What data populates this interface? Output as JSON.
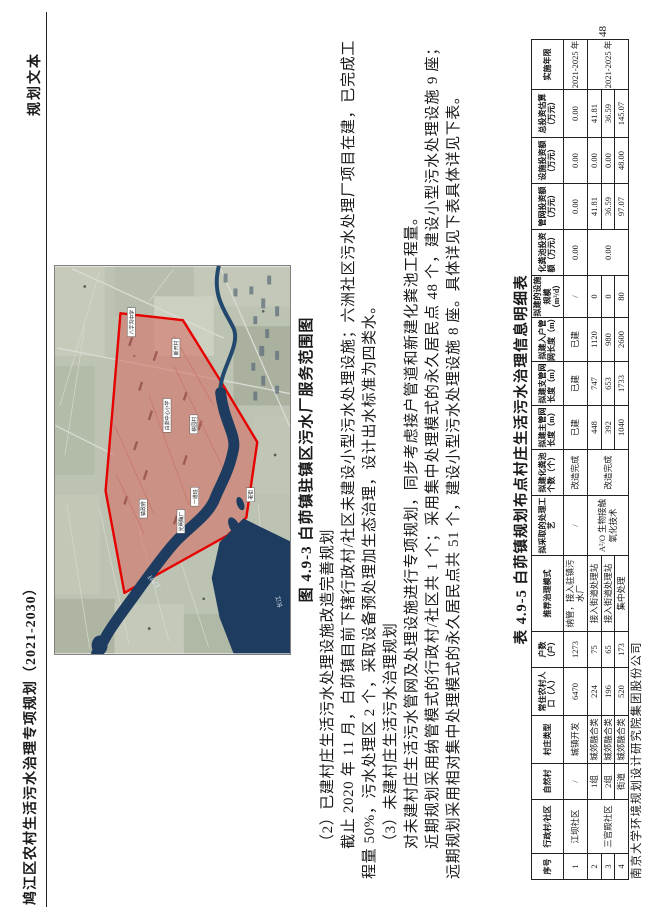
{
  "header": {
    "title": "鸠江区农村生活污水治理专项规划（2021-2030）",
    "doc_type": "规划文本"
  },
  "footer": {
    "company": "南京大学环境规划设计研究院集团股份公司",
    "page_number": "48"
  },
  "figure": {
    "caption": "图 4.9-3 白茆镇驻镇区污水厂服务范围图",
    "map_labels": [
      {
        "text": "八字沟中学"
      },
      {
        "text": "白茆中心小学"
      },
      {
        "text": "桃园村"
      },
      {
        "text": "新开村"
      },
      {
        "text": "镇政府"
      },
      {
        "text": "光明酶厂"
      },
      {
        "text": "一道班"
      },
      {
        "text": "老街"
      }
    ],
    "water_labels": [
      {
        "text": "上六圩"
      },
      {
        "text": "长江"
      }
    ]
  },
  "paragraphs": {
    "p2_heading": "（2）已建村庄生活污水处理设施改造完善规划",
    "p2_body": "截止 2020 年 11 月，白茆镇目前下辖行政村/社区未建设小型污水处理设施；六洲社区污水处理厂项目在建，已完成工程量 50%，污水处理区 2 个，采取设备预处理加生态治理，设计出水标准为四类水。",
    "p3_heading": "（3）未建村庄生活污水治理规划",
    "p3_body1": "对未建村庄生活污水管网及处理设施进行专项规划，同步考虑接户管道和新建化粪池工程量。",
    "p3_body2": "近期规划采用纳管模式的行政村/社区共 1 个；采用集中处理模式的永久居民点 48 个，建设小型污水处理设施 9 座；远期规划采用相对集中处理模式的永久居民点共 51 个，建设小型污水处理设施 8 座。具体详见下表具体详见下表。"
  },
  "table": {
    "title": "表 4.9-5 白茆镇规划布点村庄生活污水治理信息明细表",
    "headers": [
      "序号",
      "行政村/社区",
      "自然村",
      "村庄类型",
      "常住农村人口（人）",
      "户数（户）",
      "推荐治理模式",
      "拟采取的处理工艺",
      "拟建化粪池个数（个）",
      "拟建主管网长度（m）",
      "拟建支管网长度（m）",
      "拟建入户管网长度（m）",
      "拟建的设施规模（m³/d）",
      "化粪池投资额（万元）",
      "管网投资额（万元）",
      "设施投资额（万元）",
      "总投资估算（万元）",
      "实施年限"
    ],
    "rows": [
      [
        "1",
        "江坝社区",
        "/",
        "城镇开发",
        "6470",
        "1273",
        "纳管，接入驻镇污水厂",
        "/",
        "改造完成",
        "已建",
        "已建",
        "已建",
        "/",
        "0.00",
        "0.00",
        "0.00",
        "0.00",
        "2021-2025 年"
      ],
      [
        "2",
        "三官殿社区",
        "1组",
        "城郊融合类",
        "224",
        "75",
        "接入街道处理站",
        "A²/O 生物接触氧化技术",
        "改造完成",
        "448",
        "747",
        "1120",
        "0",
        "0.00",
        "41.81",
        "0.00",
        "41.81",
        "2021-2025 年"
      ],
      [
        "3",
        "2组",
        "城郊融合类",
        "196",
        "65",
        "接入街道处理站",
        "392",
        "653",
        "980",
        "0",
        "36.59",
        "0.00",
        "36.59"
      ],
      [
        "4",
        "街道",
        "城郊融合类",
        "520",
        "173",
        "集中处理",
        "1040",
        "1733",
        "2600",
        "80",
        "97.07",
        "48.00",
        "145.07"
      ]
    ]
  },
  "colors": {
    "service_area_stroke": "#e60000",
    "service_area_fill": "rgba(214,104,93,0.55)",
    "river": "#1d3c60",
    "fields": "#bdc3b3"
  }
}
